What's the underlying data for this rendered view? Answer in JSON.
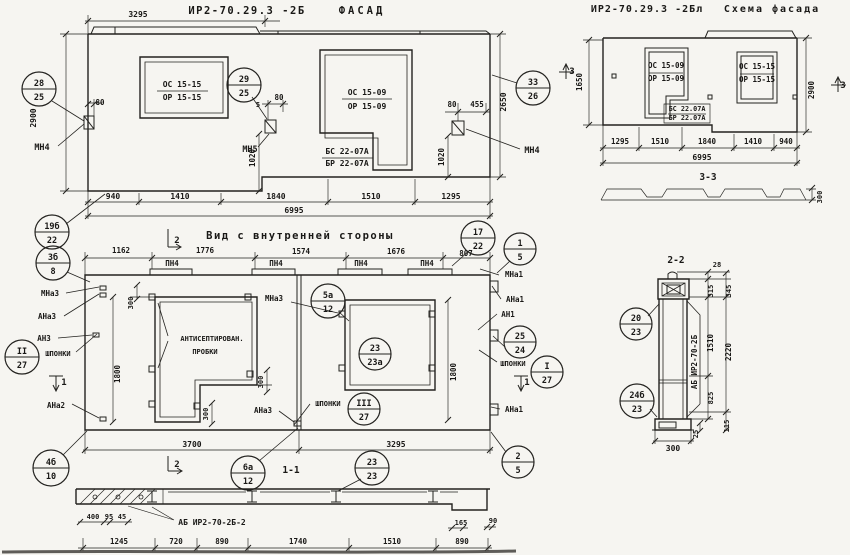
{
  "meta": {
    "panel_code": "ИР2-70.29.3 -2Б",
    "scheme_code": "ИР2-70.29.3 -2Бл",
    "views": [
      "ФАСАД",
      "Схема фасада",
      "Вид с внутренней стороны",
      "1-1",
      "2-2",
      "3-3"
    ]
  },
  "texts": [
    {
      "n": "facade-dim-3295",
      "t": "3295",
      "x": 138,
      "y": 17
    },
    {
      "n": "facade-title-code",
      "t": "ИР2-70.29.3 -2Б",
      "x": 247,
      "y": 14,
      "s": 10.5,
      "ls": 1.5
    },
    {
      "n": "facade-title-word",
      "t": "ФАСАД",
      "x": 362,
      "y": 14,
      "s": 10.5,
      "ls": 3
    },
    {
      "n": "facade-dim-2900",
      "t": "2900",
      "x": 36,
      "y": 118,
      "r": 1
    },
    {
      "n": "facade-dim-80-left",
      "t": "80",
      "x": 100,
      "y": 105,
      "s": 7.5
    },
    {
      "n": "facade-anchor-mn4-left",
      "t": "МН4",
      "x": 42,
      "y": 150,
      "s": 8.5
    },
    {
      "n": "facade-window1-os",
      "t": "ОС 15-15",
      "x": 182,
      "y": 87
    },
    {
      "n": "facade-window1-or",
      "t": "ОР 15-15",
      "x": 182,
      "y": 100
    },
    {
      "n": "facade-dim-5",
      "t": "5",
      "x": 258,
      "y": 107,
      "s": 7
    },
    {
      "n": "facade-dim-80-mid",
      "t": "80",
      "x": 279,
      "y": 100,
      "s": 7.5
    },
    {
      "n": "facade-anchor-mn5",
      "t": "МН5",
      "x": 250,
      "y": 152,
      "s": 8.5
    },
    {
      "n": "facade-window2-os",
      "t": "ОС 15-09",
      "x": 367,
      "y": 95
    },
    {
      "n": "facade-window2-or",
      "t": "ОР 15-09",
      "x": 367,
      "y": 109
    },
    {
      "n": "facade-panel-bs",
      "t": "БС 22-07А",
      "x": 347,
      "y": 154
    },
    {
      "n": "facade-panel-br",
      "t": "БР 22-07А",
      "x": 347,
      "y": 166
    },
    {
      "n": "facade-dim-80-right",
      "t": "80",
      "x": 452,
      "y": 107,
      "s": 7.5
    },
    {
      "n": "facade-dim-455",
      "t": "455",
      "x": 477,
      "y": 107,
      "s": 7.5
    },
    {
      "n": "facade-dim-1020-left",
      "t": "1020",
      "x": 255,
      "y": 158,
      "r": 1,
      "s": 7.5
    },
    {
      "n": "facade-dim-1020-right",
      "t": "1020",
      "x": 444,
      "y": 157,
      "r": 1,
      "s": 7.5
    },
    {
      "n": "facade-dim-2650",
      "t": "2650",
      "x": 506,
      "y": 102,
      "r": 1
    },
    {
      "n": "facade-anchor-mn4-right",
      "t": "МН4",
      "x": 532,
      "y": 153,
      "s": 8.5
    },
    {
      "n": "facade-dim-940",
      "t": "940",
      "x": 113,
      "y": 199
    },
    {
      "n": "facade-dim-1410",
      "t": "1410",
      "x": 180,
      "y": 199
    },
    {
      "n": "facade-dim-1840",
      "t": "1840",
      "x": 276,
      "y": 199
    },
    {
      "n": "facade-dim-1510",
      "t": "1510",
      "x": 371,
      "y": 199
    },
    {
      "n": "facade-dim-1295",
      "t": "1295",
      "x": 451,
      "y": 199
    },
    {
      "n": "facade-dim-6995",
      "t": "6995",
      "x": 294,
      "y": 213
    },
    {
      "n": "schema-title-code",
      "t": "ИР2-70.29.3 -2Бл",
      "x": 647,
      "y": 12,
      "s": 10,
      "ls": 1
    },
    {
      "n": "schema-title-word",
      "t": "Схема фасада",
      "x": 772,
      "y": 12,
      "s": 10,
      "ls": 2
    },
    {
      "n": "schema-marker3-left",
      "t": "3",
      "x": 572,
      "y": 74,
      "s": 9
    },
    {
      "n": "schema-dim-1650",
      "t": "1650",
      "x": 582,
      "y": 82,
      "r": 1,
      "s": 7.5
    },
    {
      "n": "schema-windowA-os",
      "t": "ОС 15-09",
      "x": 666,
      "y": 68,
      "s": 7.5
    },
    {
      "n": "schema-windowA-or",
      "t": "ОР 15-09",
      "x": 666,
      "y": 81,
      "s": 7.5
    },
    {
      "n": "schema-windowB-os",
      "t": "ОС 15-15",
      "x": 757,
      "y": 69,
      "s": 7.5
    },
    {
      "n": "schema-windowB-or",
      "t": "ОР 15-15",
      "x": 757,
      "y": 82,
      "s": 7.5
    },
    {
      "n": "schema-bs",
      "t": "БС 22.07А",
      "x": 687,
      "y": 111,
      "s": 6.8
    },
    {
      "n": "schema-br",
      "t": "БР 22.07А",
      "x": 687,
      "y": 120,
      "s": 6.8
    },
    {
      "n": "schema-dim-2900",
      "t": "2900",
      "x": 814,
      "y": 90,
      "r": 1,
      "s": 7.5
    },
    {
      "n": "schema-marker3-right",
      "t": "3",
      "x": 843,
      "y": 88,
      "s": 9
    },
    {
      "n": "schema-dim-1295",
      "t": "1295",
      "x": 620,
      "y": 144,
      "s": 7.5
    },
    {
      "n": "schema-dim-1510",
      "t": "1510",
      "x": 660,
      "y": 144,
      "s": 7.5
    },
    {
      "n": "schema-dim-1840",
      "t": "1840",
      "x": 707,
      "y": 144,
      "s": 7.5
    },
    {
      "n": "schema-dim-1410",
      "t": "1410",
      "x": 753,
      "y": 144,
      "s": 7.5
    },
    {
      "n": "schema-dim-940",
      "t": "940",
      "x": 786,
      "y": 144,
      "s": 7.5
    },
    {
      "n": "schema-dim-6995",
      "t": "6995",
      "x": 702,
      "y": 160
    },
    {
      "n": "schema-section-label",
      "t": "3-3",
      "x": 708,
      "y": 180,
      "s": 9.5
    },
    {
      "n": "schema-dim-300",
      "t": "300",
      "x": 822,
      "y": 197,
      "r": 1,
      "s": 7
    },
    {
      "n": "view-marker2-top",
      "t": "2",
      "x": 177,
      "y": 243,
      "s": 9
    },
    {
      "n": "view-title",
      "t": "Вид с внутренней стороны",
      "x": 300,
      "y": 239,
      "s": 10.5,
      "ls": 1.5
    },
    {
      "n": "view-dim-1162",
      "t": "1162",
      "x": 121,
      "y": 253,
      "s": 7.5
    },
    {
      "n": "view-dim-1776",
      "t": "1776",
      "x": 205,
      "y": 253,
      "s": 7.5
    },
    {
      "n": "view-dim-1574",
      "t": "1574",
      "x": 301,
      "y": 254,
      "s": 7.5
    },
    {
      "n": "view-dim-1676",
      "t": "1676",
      "x": 396,
      "y": 254,
      "s": 7.5
    },
    {
      "n": "view-dim-807",
      "t": "807",
      "x": 466,
      "y": 256,
      "s": 7.5
    },
    {
      "n": "view-pn4-1",
      "t": "ПН4",
      "x": 172,
      "y": 266,
      "s": 7.5
    },
    {
      "n": "view-pn4-2",
      "t": "ПН4",
      "x": 276,
      "y": 266,
      "s": 7.5
    },
    {
      "n": "view-pn4-3",
      "t": "ПН4",
      "x": 361,
      "y": 266,
      "s": 7.5
    },
    {
      "n": "view-pn4-4",
      "t": "ПН4",
      "x": 427,
      "y": 266,
      "s": 7.5
    },
    {
      "n": "view-mna3-mid",
      "t": "МНа3",
      "x": 274,
      "y": 301,
      "s": 7.5
    },
    {
      "n": "view-mna3-left",
      "t": "МНа3",
      "x": 50,
      "y": 296,
      "s": 7.5
    },
    {
      "n": "view-ana3-left",
      "t": "АНа3",
      "x": 47,
      "y": 319,
      "s": 7.5
    },
    {
      "n": "view-an3-left",
      "t": "АН3",
      "x": 44,
      "y": 341,
      "s": 7.5
    },
    {
      "n": "view-shponki-left",
      "t": "ШПОНКИ",
      "x": 58,
      "y": 356,
      "s": 7
    },
    {
      "n": "view-marker1-left",
      "t": "1",
      "x": 64,
      "y": 385,
      "s": 9
    },
    {
      "n": "view-ana2-left",
      "t": "АНа2",
      "x": 56,
      "y": 408,
      "s": 7.5
    },
    {
      "n": "view-dim-1800-left",
      "t": "1800",
      "x": 120,
      "y": 374,
      "r": 1,
      "s": 7.5
    },
    {
      "n": "view-antiseptic-line1",
      "t": "АНТИСЕПТИРОВАН.",
      "x": 212,
      "y": 341,
      "s": 7
    },
    {
      "n": "view-antiseptic-line2",
      "t": "ПРОБКИ",
      "x": 205,
      "y": 354,
      "s": 7
    },
    {
      "n": "view-dim-300-top",
      "t": "300",
      "x": 133,
      "y": 303,
      "r": 1,
      "s": 7
    },
    {
      "n": "view-dim-300-mid",
      "t": "300",
      "x": 263,
      "y": 382,
      "r": 1,
      "s": 7
    },
    {
      "n": "view-dim-300-bot",
      "t": "300",
      "x": 208,
      "y": 414,
      "r": 1,
      "s": 7
    },
    {
      "n": "view-dim-1800-right",
      "t": "1800",
      "x": 456,
      "y": 372,
      "r": 1,
      "s": 7.5
    },
    {
      "n": "view-shponki-mid",
      "t": "ШПОНКИ",
      "x": 328,
      "y": 406,
      "s": 7
    },
    {
      "n": "view-shponki-right",
      "t": "ШПОНКИ",
      "x": 513,
      "y": 366,
      "s": 7
    },
    {
      "n": "view-mna1-right",
      "t": "МНа1",
      "x": 514,
      "y": 277,
      "s": 7.5
    },
    {
      "n": "view-ana1-top-right",
      "t": "АНа1",
      "x": 515,
      "y": 302,
      "s": 7.5
    },
    {
      "n": "view-an1-right",
      "t": "АН1",
      "x": 508,
      "y": 317,
      "s": 7.5
    },
    {
      "n": "view-marker1-right",
      "t": "1",
      "x": 527,
      "y": 385,
      "s": 9
    },
    {
      "n": "view-ana1-bot-right",
      "t": "АНа1",
      "x": 514,
      "y": 412,
      "s": 7.5
    },
    {
      "n": "view-ana3-mid",
      "t": "АНа3",
      "x": 263,
      "y": 413,
      "s": 7.5
    },
    {
      "n": "view-dim-3700",
      "t": "3700",
      "x": 192,
      "y": 447
    },
    {
      "n": "view-dim-3295",
      "t": "3295",
      "x": 396,
      "y": 447
    },
    {
      "n": "view-marker2-bot",
      "t": "2",
      "x": 177,
      "y": 467,
      "s": 9
    },
    {
      "n": "view-section-label-11",
      "t": "1-1",
      "x": 291,
      "y": 473,
      "s": 9.5
    },
    {
      "n": "sec1-dim-400",
      "t": "400",
      "x": 93,
      "y": 519,
      "s": 7
    },
    {
      "n": "sec1-dim-95",
      "t": "95",
      "x": 109,
      "y": 519,
      "s": 7
    },
    {
      "n": "sec1-dim-45",
      "t": "45",
      "x": 122,
      "y": 519,
      "s": 7
    },
    {
      "n": "sec1-label-ab",
      "t": "АБ ИР2-70-2Б-2",
      "x": 212,
      "y": 525,
      "s": 8
    },
    {
      "n": "sec1-dim-1245",
      "t": "1245",
      "x": 119,
      "y": 544,
      "s": 7.5
    },
    {
      "n": "sec1-dim-720",
      "t": "720",
      "x": 176,
      "y": 544,
      "s": 7.5
    },
    {
      "n": "sec1-dim-890a",
      "t": "890",
      "x": 222,
      "y": 544,
      "s": 7.5
    },
    {
      "n": "sec1-dim-1740",
      "t": "1740",
      "x": 298,
      "y": 544,
      "s": 7.5
    },
    {
      "n": "sec1-dim-1510",
      "t": "1510",
      "x": 392,
      "y": 544,
      "s": 7.5
    },
    {
      "n": "sec1-dim-890b",
      "t": "890",
      "x": 462,
      "y": 544,
      "s": 7.5
    },
    {
      "n": "sec1-dim-165",
      "t": "165",
      "x": 461,
      "y": 525,
      "s": 7
    },
    {
      "n": "sec1-dim-90",
      "t": "90",
      "x": 493,
      "y": 523,
      "s": 7
    },
    {
      "n": "sec2-title",
      "t": "2-2",
      "x": 676,
      "y": 263,
      "s": 9.5
    },
    {
      "n": "sec2-dim-28",
      "t": "28",
      "x": 717,
      "y": 267,
      "s": 7
    },
    {
      "n": "sec2-dim-315",
      "t": "315",
      "x": 713,
      "y": 291,
      "r": 1,
      "s": 7
    },
    {
      "n": "sec2-dim-345",
      "t": "345",
      "x": 731,
      "y": 291,
      "r": 1,
      "s": 7
    },
    {
      "n": "sec2-dim-1510",
      "t": "1510",
      "x": 713,
      "y": 343,
      "r": 1,
      "s": 7.5
    },
    {
      "n": "sec2-dim-2220",
      "t": "2220",
      "x": 731,
      "y": 352,
      "r": 1,
      "s": 7.5
    },
    {
      "n": "sec2-dim-825",
      "t": "825",
      "x": 713,
      "y": 398,
      "r": 1,
      "s": 7
    },
    {
      "n": "sec2-dim-25",
      "t": "25",
      "x": 698,
      "y": 434,
      "r": 1,
      "s": 7
    },
    {
      "n": "sec2-dim-115",
      "t": "115",
      "x": 729,
      "y": 426,
      "r": 1,
      "s": 7
    },
    {
      "n": "sec2-dim-300",
      "t": "300",
      "x": 673,
      "y": 451
    },
    {
      "n": "sec2-label-ab",
      "t": "АБ ИР2-70-2Б",
      "x": 697,
      "y": 362,
      "r": 1,
      "s": 7.5
    }
  ],
  "balloons": [
    {
      "n": "balloon-28-25",
      "x": 39,
      "y": 89,
      "rad": 17,
      "top": "28",
      "bottom": "25"
    },
    {
      "n": "balloon-29-25",
      "x": 244,
      "y": 85,
      "rad": 17,
      "top": "29",
      "bottom": "25"
    },
    {
      "n": "balloon-33-26",
      "x": 533,
      "y": 88,
      "rad": 17,
      "top": "33",
      "bottom": "26"
    },
    {
      "n": "balloon-19b-22",
      "x": 52,
      "y": 232,
      "rad": 17,
      "top": "19б",
      "bottom": "22"
    },
    {
      "n": "balloon-3b-8",
      "x": 53,
      "y": 263,
      "rad": 17,
      "top": "3б",
      "bottom": "8"
    },
    {
      "n": "balloon-II-27",
      "x": 22,
      "y": 357,
      "rad": 17,
      "top": "II",
      "bottom": "27"
    },
    {
      "n": "ballo0n-17-22",
      "x": 478,
      "y": 238,
      "rad": 17,
      "top": "17",
      "bottom": "22"
    },
    {
      "n": "balloon-1-5",
      "x": 520,
      "y": 249,
      "rad": 16,
      "top": "1",
      "bottom": "5"
    },
    {
      "n": "balloon-25-24",
      "x": 520,
      "y": 342,
      "rad": 16,
      "top": "25",
      "bottom": "24"
    },
    {
      "n": "balloon-I-27",
      "x": 547,
      "y": 372,
      "rad": 16,
      "top": "I",
      "bottom": "27"
    },
    {
      "n": "balloon-5a-12",
      "x": 328,
      "y": 301,
      "rad": 17,
      "top": "5а",
      "bottom": "12"
    },
    {
      "n": "balloon-23-23a",
      "x": 375,
      "y": 354,
      "rad": 16,
      "top": "23",
      "bottom": "23а"
    },
    {
      "n": "balloon-III-27",
      "x": 364,
      "y": 409,
      "rad": 16,
      "top": "III",
      "bottom": "27"
    },
    {
      "n": "balloon-4b-10",
      "x": 51,
      "y": 468,
      "rad": 18,
      "top": "4б",
      "bottom": "10"
    },
    {
      "n": "balloon-6a-12",
      "x": 248,
      "y": 473,
      "rad": 17,
      "top": "6а",
      "bottom": "12"
    },
    {
      "n": "balloon-23-23",
      "x": 372,
      "y": 468,
      "rad": 17,
      "top": "23",
      "bottom": "23"
    },
    {
      "n": "balloon-2-5",
      "x": 518,
      "y": 462,
      "rad": 16,
      "top": "2",
      "bottom": "5"
    },
    {
      "n": "balloon-20-23",
      "x": 636,
      "y": 324,
      "rad": 16,
      "top": "20",
      "bottom": "23"
    },
    {
      "n": "balloon-24b-23",
      "x": 637,
      "y": 401,
      "rad": 17,
      "top": "24б",
      "bottom": "23"
    }
  ]
}
